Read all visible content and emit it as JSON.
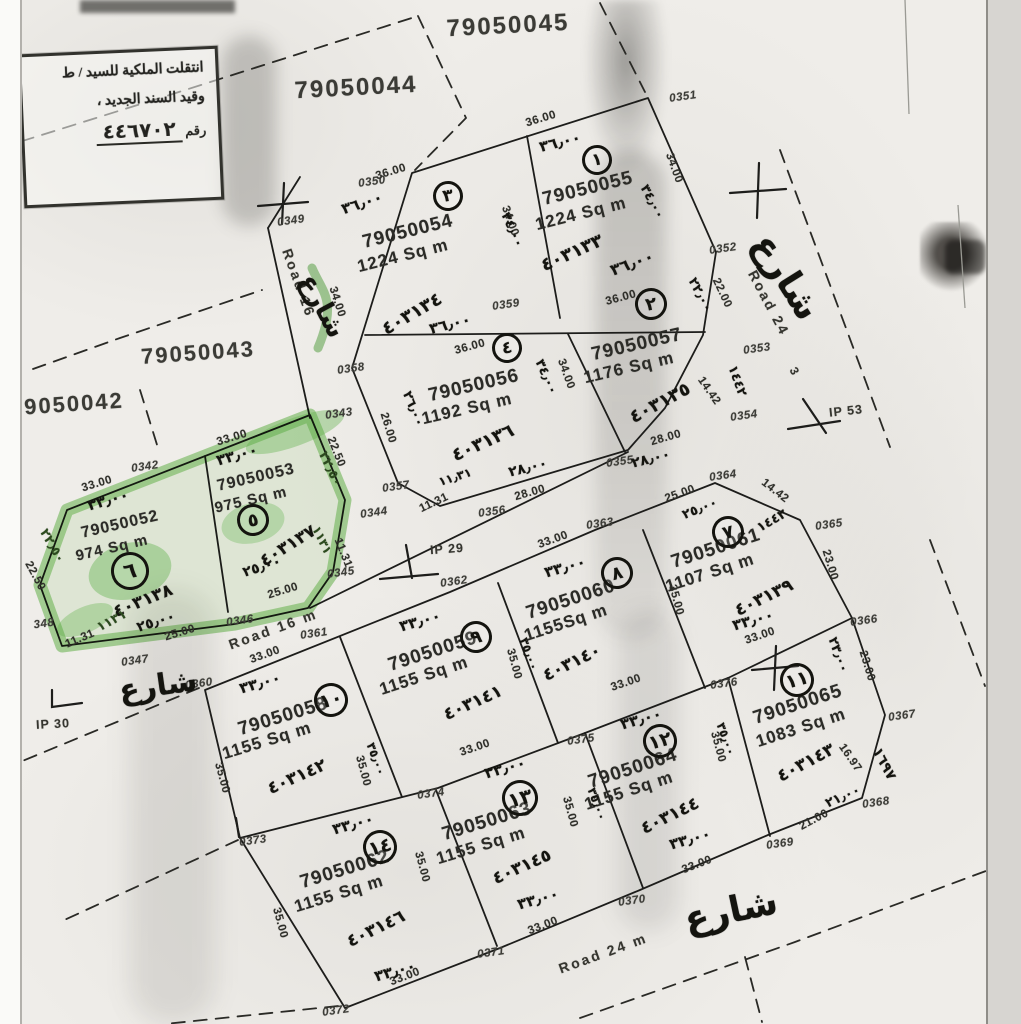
{
  "document_kind": "scanned cadastral plat map",
  "colors": {
    "paper": "#efede9",
    "ink": "#242420",
    "highlight_green": "#6cbf5a",
    "scan_edge": "#d7d5d1"
  },
  "stamp": {
    "line1": "انتقلت الملكية للسيد / ط",
    "line2": "وقيد السند الجديد ،",
    "line3_label": "رقم",
    "line3_number": "٤٤٦٧٠٢"
  },
  "roads": [
    {
      "label": "Road 16"
    },
    {
      "label": "Road 16 m"
    },
    {
      "label": "Road 24"
    },
    {
      "label": "Road 24 m"
    }
  ],
  "plots": [
    {
      "circle": "١",
      "number": "79050055",
      "area": "1224 Sq m",
      "deed_hw": "٤٠٣١٣٣"
    },
    {
      "circle": "٢",
      "number": "79050057",
      "area": "1176 Sq m",
      "deed_hw": "٤٠٣١٣٥"
    },
    {
      "circle": "٣",
      "number": "79050054",
      "area": "1224 Sq m",
      "deed_hw": "٤٠٣١٣٤"
    },
    {
      "circle": "٤",
      "number": "79050056",
      "area": "1192 Sq m",
      "deed_hw": "٤٠٣١٣٦"
    },
    {
      "circle": "٥",
      "number": "79050053",
      "area": "975 Sq m",
      "deed_hw": "٤٠٣١٣٧",
      "highlighted": true
    },
    {
      "circle": "٦",
      "number": "79050052",
      "area": "974 Sq m",
      "deed_hw": "٤٠٣١٣٨",
      "highlighted": true
    },
    {
      "circle": "٧",
      "number": "79050061",
      "area": "1107 Sq m",
      "deed_hw": "٤٠٣١٣٩"
    },
    {
      "circle": "٨",
      "number": "79050060",
      "area": "1155Sq m",
      "deed_hw": "٤٠٣١٤٠"
    },
    {
      "circle": "٩",
      "number": "79050059",
      "area": "1155 Sq m",
      "deed_hw": "٤٠٣١٤١"
    },
    {
      "circle": "١٠",
      "number": "79050058",
      "area": "1155 Sq m",
      "deed_hw": "٤٠٣١٤٢"
    },
    {
      "circle": "١١",
      "number": "79050065",
      "area": "1083 Sq m",
      "deed_hw": "٤٠٣١٤٣"
    },
    {
      "circle": "١٢",
      "number": "79050064",
      "area": "1155 Sq m",
      "deed_hw": "٤٠٣١٤٤"
    },
    {
      "circle": "١٣",
      "number": "79050063",
      "area": "1155 Sq m",
      "deed_hw": "٤٠٣١٤٥"
    },
    {
      "circle": "١٤",
      "number": "79050062",
      "area": "1155 Sq m",
      "deed_hw": "٤٠٣١٤٦"
    }
  ],
  "labels": [
    [
      "blk",
      "79050045",
      508,
      26,
      -3,
      24
    ],
    [
      "blk",
      "79050044",
      356,
      88,
      -3,
      24
    ],
    [
      "blk",
      "79050043",
      198,
      353,
      -4,
      22
    ],
    [
      "blk",
      "9050042",
      74,
      404,
      -4,
      22
    ],
    [
      "pn",
      "79050054",
      408,
      232,
      -14,
      19
    ],
    [
      "ar",
      "1224 Sq m",
      403,
      256,
      -14,
      17
    ],
    [
      "pn",
      "79050055",
      588,
      189,
      -14,
      19
    ],
    [
      "ar",
      "1224 Sq m",
      581,
      214,
      -14,
      17
    ],
    [
      "pn",
      "79050056",
      474,
      386,
      -13,
      19
    ],
    [
      "ar",
      "1192 Sq m",
      467,
      409,
      -13,
      17
    ],
    [
      "pn",
      "79050057",
      637,
      345,
      -13,
      19
    ],
    [
      "ar",
      "1176 Sq m",
      629,
      368,
      -13,
      17
    ],
    [
      "pn",
      "79050053",
      256,
      478,
      -13,
      16
    ],
    [
      "ar",
      "975 Sq m",
      251,
      500,
      -13,
      15
    ],
    [
      "pn",
      "79050052",
      120,
      525,
      -13,
      16
    ],
    [
      "ar",
      "974 Sq m",
      112,
      548,
      -13,
      15
    ],
    [
      "pn",
      "79050059",
      433,
      652,
      -18,
      19
    ],
    [
      "ar",
      "1155 Sq m",
      424,
      676,
      -18,
      17
    ],
    [
      "pn",
      "79050060",
      571,
      600,
      -18,
      19
    ],
    [
      "ar",
      "1155Sq m",
      566,
      623,
      -18,
      17
    ],
    [
      "pn",
      "79050061",
      716,
      549,
      -18,
      19
    ],
    [
      "ar",
      "1107 Sq m",
      710,
      573,
      -18,
      17
    ],
    [
      "pn",
      "79050058",
      283,
      717,
      -17,
      19
    ],
    [
      "ar",
      "1155 Sq m",
      267,
      741,
      -17,
      17
    ],
    [
      "pn",
      "79050064",
      633,
      769,
      -18,
      19
    ],
    [
      "ar",
      "1155 Sq m",
      629,
      791,
      -18,
      17
    ],
    [
      "pn",
      "79050065",
      798,
      705,
      -18,
      19
    ],
    [
      "ar",
      "1083 Sq m",
      801,
      728,
      -18,
      17
    ],
    [
      "pn",
      "79050063",
      487,
      822,
      -17,
      19
    ],
    [
      "ar",
      "1155 Sq m",
      481,
      846,
      -17,
      17
    ],
    [
      "pn",
      "79050062",
      345,
      870,
      -17,
      19
    ],
    [
      "ar",
      "1155 Sq m",
      339,
      894,
      -17,
      17
    ],
    [
      "mk",
      "0342",
      145,
      467,
      -8,
      11.5
    ],
    [
      "mk",
      "0343",
      339,
      414,
      -8,
      11.5
    ],
    [
      "mk",
      "0344",
      374,
      513,
      -8,
      11.5
    ],
    [
      "mk",
      "0345",
      341,
      573,
      -8,
      11.5
    ],
    [
      "mk",
      "0346",
      240,
      621,
      -8,
      11.5
    ],
    [
      "mk",
      "0347",
      135,
      661,
      -8,
      11.5
    ],
    [
      "mk",
      "348",
      44,
      624,
      -8,
      11.5
    ],
    [
      "mk",
      "0349",
      291,
      221,
      -8,
      11.5
    ],
    [
      "mk",
      "0350",
      372,
      182,
      -8,
      11.5
    ],
    [
      "mk",
      "0351",
      683,
      97,
      -8,
      11.5
    ],
    [
      "mk",
      "0352",
      723,
      249,
      -8,
      11.5
    ],
    [
      "mk",
      "0353",
      757,
      349,
      -8,
      11.5
    ],
    [
      "mk",
      "0354",
      744,
      416,
      -8,
      11.5
    ],
    [
      "mk",
      "0355",
      620,
      462,
      -8,
      11.5
    ],
    [
      "mk",
      "0356",
      492,
      512,
      -8,
      11.5
    ],
    [
      "mk",
      "0357",
      396,
      487,
      -8,
      11.5
    ],
    [
      "mk",
      "0358",
      351,
      369,
      -8,
      11.5
    ],
    [
      "mk",
      "0359",
      506,
      305,
      -8,
      11.5
    ],
    [
      "mk",
      "0360",
      199,
      684,
      -8,
      11.5
    ],
    [
      "mk",
      "0361",
      314,
      634,
      -8,
      11.5
    ],
    [
      "mk",
      "0362",
      454,
      582,
      -8,
      11.5
    ],
    [
      "mk",
      "0363",
      600,
      524,
      -8,
      11.5
    ],
    [
      "mk",
      "0364",
      723,
      476,
      -8,
      11.5
    ],
    [
      "mk",
      "0365",
      829,
      525,
      -8,
      11.5
    ],
    [
      "mk",
      "0366",
      864,
      621,
      -8,
      11.5
    ],
    [
      "mk",
      "0367",
      902,
      716,
      -8,
      11.5
    ],
    [
      "mk",
      "0368",
      876,
      803,
      -8,
      11.5
    ],
    [
      "mk",
      "0369",
      780,
      844,
      -8,
      11.5
    ],
    [
      "mk",
      "0370",
      632,
      901,
      -8,
      11.5
    ],
    [
      "mk",
      "0371",
      491,
      953,
      -8,
      11.5
    ],
    [
      "mk",
      "0372",
      336,
      1011,
      -8,
      11.5
    ],
    [
      "mk",
      "0373",
      253,
      841,
      -8,
      11.5
    ],
    [
      "mk",
      "0374",
      431,
      794,
      -8,
      11.5
    ],
    [
      "mk",
      "0375",
      581,
      740,
      -8,
      11.5
    ],
    [
      "mk",
      "0376",
      724,
      684,
      -8,
      11.5
    ],
    [
      "dim",
      "36.00",
      541,
      119,
      -17,
      11.5
    ],
    [
      "dim",
      "36.00",
      391,
      172,
      -17,
      11.5
    ],
    [
      "dim",
      "36.00",
      470,
      347,
      -15,
      11.5
    ],
    [
      "dim",
      "36.00",
      621,
      298,
      -15,
      11.5
    ],
    [
      "dim",
      "34.00",
      337,
      302,
      72,
      11.5
    ],
    [
      "dim",
      "34.00",
      674,
      168,
      70,
      11.5
    ],
    [
      "dim",
      "34.00",
      510,
      221,
      70,
      11.5
    ],
    [
      "dim",
      "34.00",
      566,
      374,
      70,
      11.5
    ],
    [
      "dim",
      "22.00",
      722,
      293,
      65,
      11.5
    ],
    [
      "dim",
      "26.00",
      388,
      428,
      73,
      11.5
    ],
    [
      "dim",
      "28.00",
      530,
      493,
      -16,
      11.5
    ],
    [
      "dim",
      "28.00",
      666,
      438,
      -16,
      11.5
    ],
    [
      "dim",
      "11.31",
      434,
      503,
      -25,
      11.5
    ],
    [
      "dim",
      "14.42",
      709,
      391,
      55,
      11.5
    ],
    [
      "dim",
      "33.00",
      97,
      484,
      -17,
      11.5
    ],
    [
      "dim",
      "33.00",
      232,
      438,
      -17,
      11.5
    ],
    [
      "dim",
      "22.50",
      35,
      576,
      62,
      11.5
    ],
    [
      "dim",
      "11.31",
      80,
      639,
      -23,
      11.5
    ],
    [
      "dim",
      "25.00",
      180,
      633,
      -17,
      11.5
    ],
    [
      "dim",
      "25.00",
      283,
      591,
      -17,
      11.5
    ],
    [
      "dim",
      "22.50",
      336,
      452,
      68,
      11.5
    ],
    [
      "dim",
      "11.31",
      343,
      553,
      68,
      11.5
    ],
    [
      "dim",
      "33.00",
      265,
      655,
      -20,
      11.5
    ],
    [
      "dim",
      "33.00",
      553,
      540,
      -20,
      11.5
    ],
    [
      "dim",
      "25.00",
      680,
      494,
      -20,
      11.5
    ],
    [
      "dim",
      "14.42",
      775,
      491,
      38,
      11.5
    ],
    [
      "dim",
      "23.00",
      830,
      565,
      73,
      11.5
    ],
    [
      "dim",
      "23.00",
      867,
      666,
      73,
      11.5
    ],
    [
      "dim",
      "16.97",
      850,
      758,
      55,
      11.5
    ],
    [
      "dim",
      "21.00",
      814,
      820,
      -28,
      11.5
    ],
    [
      "dim",
      "33.00",
      697,
      865,
      -21,
      11.5
    ],
    [
      "dim",
      "33.00",
      543,
      926,
      -21,
      11.5
    ],
    [
      "dim",
      "33.00",
      405,
      977,
      -21,
      11.5
    ],
    [
      "dim",
      "33.00",
      475,
      748,
      -19,
      11.5
    ],
    [
      "dim",
      "33.00",
      626,
      683,
      -19,
      11.5
    ],
    [
      "dim",
      "33.00",
      760,
      636,
      -19,
      11.5
    ],
    [
      "dim",
      "35.00",
      222,
      778,
      75,
      11.5
    ],
    [
      "dim",
      "35.00",
      280,
      923,
      75,
      11.5
    ],
    [
      "dim",
      "35.00",
      363,
      771,
      75,
      11.5
    ],
    [
      "dim",
      "35.00",
      514,
      664,
      75,
      11.5
    ],
    [
      "dim",
      "35.00",
      676,
      600,
      75,
      11.5
    ],
    [
      "dim",
      "35.00",
      718,
      747,
      75,
      11.5
    ],
    [
      "dim",
      "35.00",
      570,
      812,
      75,
      11.5
    ],
    [
      "dim",
      "35.00",
      422,
      867,
      75,
      11.5
    ],
    [
      "road",
      "Road 16",
      299,
      283,
      70,
      14
    ],
    [
      "road",
      "Road 16 m",
      273,
      629,
      -20,
      14
    ],
    [
      "road",
      "Road 24",
      769,
      303,
      62,
      14
    ],
    [
      "road",
      "3",
      795,
      372,
      62,
      12
    ],
    [
      "road",
      "Road 24 m",
      603,
      953,
      -20,
      14
    ],
    [
      "ip",
      "IP 29",
      447,
      549,
      -4,
      12.5
    ],
    [
      "ip",
      "IP 30",
      53,
      724,
      -3,
      12.5
    ],
    [
      "ip",
      "IP 53",
      846,
      411,
      -6,
      12.5
    ],
    [
      "hw",
      "٣٦٫٠٠",
      560,
      142,
      -14,
      15
    ],
    [
      "hw",
      "٣٦٫٠٠",
      362,
      203,
      -18,
      15
    ],
    [
      "hw",
      "٣٦٫٠٠",
      450,
      324,
      -14,
      15
    ],
    [
      "hw",
      "٣٦٫٠٠",
      632,
      263,
      -20,
      16
    ],
    [
      "hw",
      "٣٤٫٠٠",
      652,
      202,
      62,
      13
    ],
    [
      "hw",
      "٣٤٫٠٠",
      512,
      230,
      66,
      13
    ],
    [
      "hw",
      "٣٤٫٠٠",
      546,
      377,
      66,
      13
    ],
    [
      "hw",
      "٤٠٣١٣٣",
      572,
      253,
      -24,
      18
    ],
    [
      "hw",
      "٤٠٣١٣٤",
      412,
      314,
      -30,
      18
    ],
    [
      "hw",
      "٤٠٣١٣٦",
      483,
      443,
      -24,
      18
    ],
    [
      "hw",
      "٤٠٣١٣٥",
      660,
      403,
      -28,
      18
    ],
    [
      "hw",
      "٢٨٫٠٠",
      528,
      468,
      -14,
      14
    ],
    [
      "hw",
      "٢٨٫٠٠",
      651,
      459,
      -14,
      14
    ],
    [
      "hw",
      "٢٦٫٠٠",
      413,
      409,
      68,
      13
    ],
    [
      "hw",
      "١١٫٣١",
      455,
      477,
      -18,
      12
    ],
    [
      "hw",
      "٢٢٫٠٠",
      700,
      295,
      62,
      13
    ],
    [
      "hw",
      "١٤٤٢",
      737,
      381,
      70,
      13
    ],
    [
      "hw",
      "٤٠٣١٣٧",
      288,
      546,
      -32,
      17
    ],
    [
      "hw",
      "٤٠٣١٣٨",
      143,
      601,
      -22,
      17
    ],
    [
      "hw",
      "٣٣٫٠٠",
      237,
      455,
      -16,
      15
    ],
    [
      "hw",
      "٣٣٫٠٠",
      108,
      500,
      -16,
      15
    ],
    [
      "hw",
      "٢٥٫٠٠",
      262,
      567,
      -18,
      14
    ],
    [
      "hw",
      "٢٥٫٠٠",
      156,
      622,
      -18,
      14
    ],
    [
      "hw",
      "٤٠٣١٣٩",
      764,
      598,
      -26,
      17
    ],
    [
      "hw",
      "٤٠٣١٤٠",
      572,
      663,
      -26,
      17
    ],
    [
      "hw",
      "٤٠٣١٤١",
      473,
      703,
      -24,
      17
    ],
    [
      "hw",
      "٤٠٣١٤٢",
      297,
      777,
      -24,
      17
    ],
    [
      "hw",
      "٤٠٣١٤٣",
      806,
      763,
      -28,
      17
    ],
    [
      "hw",
      "٤٠٣١٤٤",
      670,
      816,
      -26,
      17
    ],
    [
      "hw",
      "٤٠٣١٤٥",
      522,
      867,
      -24,
      17
    ],
    [
      "hw",
      "٤٠٣١٤٦",
      376,
      929,
      -26,
      17
    ],
    [
      "hw",
      "٣٣٫٠٠",
      420,
      621,
      -16,
      15
    ],
    [
      "hw",
      "٣٣٫٠٠",
      565,
      567,
      -16,
      15
    ],
    [
      "hw",
      "٣٣٫٠٠",
      753,
      620,
      -16,
      15
    ],
    [
      "hw",
      "٣٣٫٠٠",
      260,
      683,
      -16,
      15
    ],
    [
      "hw",
      "٣٣٫٠٠",
      641,
      719,
      -16,
      15
    ],
    [
      "hw",
      "٣٣٫٠٠",
      690,
      839,
      -16,
      15
    ],
    [
      "hw",
      "٣٣٫٠٠",
      505,
      768,
      -16,
      15
    ],
    [
      "hw",
      "٣٣٫٠٠",
      538,
      899,
      -16,
      15
    ],
    [
      "hw",
      "٣٣٫٠٠",
      353,
      824,
      -16,
      15
    ],
    [
      "hw",
      "٣٣٫٠٠",
      395,
      971,
      -16,
      15
    ],
    [
      "hw",
      "٢٥٫٠٠",
      700,
      509,
      -22,
      13
    ],
    [
      "hw",
      "١٤٤٢",
      772,
      521,
      -30,
      13
    ],
    [
      "hw",
      "٢١٫٠٠",
      843,
      797,
      -24,
      13
    ],
    [
      "hw",
      "١٦٩٧",
      884,
      764,
      62,
      14
    ],
    [
      "hw",
      "٢٣٫٠٠",
      838,
      655,
      70,
      13
    ],
    [
      "hw",
      "٣٥٫٠٠",
      376,
      759,
      70,
      12
    ],
    [
      "hw",
      "٣٥٫٠٠",
      529,
      654,
      70,
      12
    ],
    [
      "hw",
      "٣٥٫٠٠",
      597,
      804,
      70,
      12
    ],
    [
      "hw",
      "٣٥٫٠٠",
      726,
      739,
      70,
      12
    ],
    [
      "hwg",
      "٢٢٫٥٠",
      52,
      546,
      60,
      13
    ],
    [
      "hwg",
      "١١٣١",
      112,
      621,
      -28,
      13
    ],
    [
      "hwg",
      "٢٢٫٥٠",
      330,
      469,
      64,
      13
    ],
    [
      "hwg",
      "١١٣١",
      322,
      540,
      64,
      12
    ],
    [
      "hw",
      "شارع",
      322,
      306,
      62,
      26
    ],
    [
      "hw",
      "شارع",
      158,
      686,
      -8,
      30
    ],
    [
      "hw",
      "شارع",
      786,
      277,
      58,
      36
    ],
    [
      "hw",
      "شارع",
      731,
      911,
      -12,
      36
    ]
  ],
  "circles": [
    [
      "١",
      597,
      160,
      -10,
      30
    ],
    [
      "٣",
      448,
      196,
      -10,
      30
    ],
    [
      "٤",
      507,
      348,
      -10,
      30
    ],
    [
      "٢",
      651,
      304,
      -10,
      32
    ],
    [
      "٥",
      253,
      520,
      -10,
      32
    ],
    [
      "٦",
      130,
      571,
      -12,
      38
    ],
    [
      "٧",
      728,
      532,
      -15,
      32
    ],
    [
      "٨",
      617,
      573,
      -15,
      32
    ],
    [
      "٩",
      476,
      637,
      -15,
      32
    ],
    [
      "١٠",
      331,
      700,
      -15,
      34
    ],
    [
      "١١",
      797,
      680,
      -15,
      34
    ],
    [
      "١٢",
      660,
      741,
      -15,
      34
    ],
    [
      "١٣",
      520,
      798,
      -15,
      36
    ],
    [
      "١٤",
      380,
      847,
      -15,
      34
    ]
  ]
}
